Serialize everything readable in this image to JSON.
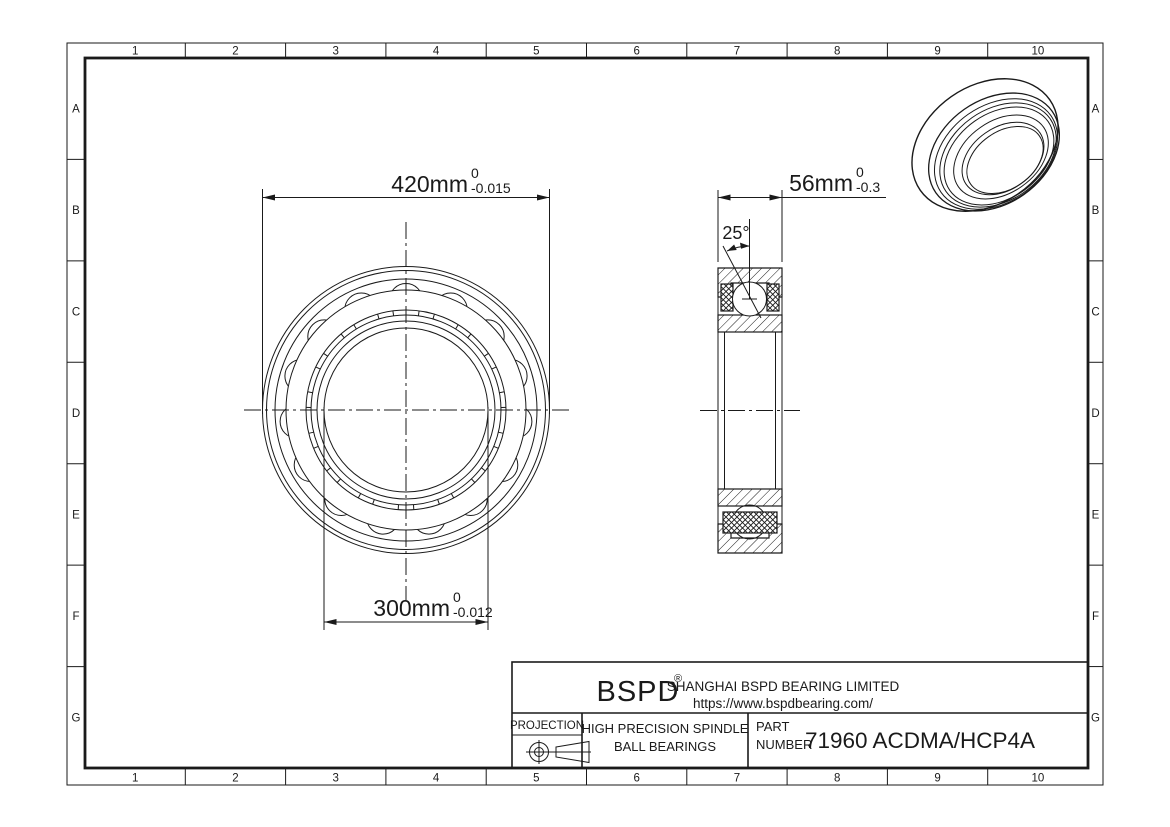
{
  "grid": {
    "columns": [
      "1",
      "2",
      "3",
      "4",
      "5",
      "6",
      "7",
      "8",
      "9",
      "10"
    ],
    "rows": [
      "A",
      "B",
      "C",
      "D",
      "E",
      "F",
      "G"
    ]
  },
  "front_view": {
    "outer_diameter": {
      "value": "420mm",
      "tol_upper": "0",
      "tol_lower": "-0.015"
    },
    "bore_diameter": {
      "value": "300mm",
      "tol_upper": "0",
      "tol_lower": "-0.012"
    }
  },
  "side_view": {
    "width": {
      "value": "56mm",
      "tol_upper": "0",
      "tol_lower": "-0.3"
    },
    "contact_angle": "25°"
  },
  "title_block": {
    "logo": "BSPD",
    "logo_mark": "®",
    "company": "SHANGHAI BSPD BEARING LIMITED",
    "website": "https://www.bspdbearing.com/",
    "projection_label": "PROJECTION",
    "product_line_1": "HIGH  PRECISION SPINDLE",
    "product_line_2": "BALL BEARINGS",
    "part_label_line_1": "PART",
    "part_label_line_2": "NUMBER",
    "part_number": "71960 ACDMA/HCP4A"
  },
  "colors": {
    "line": "#1a1a1a",
    "background": "#ffffff"
  }
}
